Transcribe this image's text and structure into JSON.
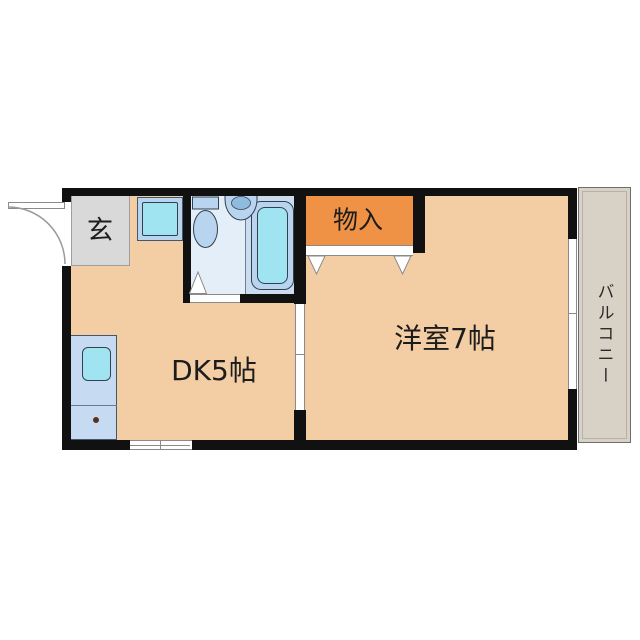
{
  "plan": {
    "type": "apartment-floor-plan",
    "rooms": {
      "entrance": {
        "label": "玄"
      },
      "storage": {
        "label": "物入"
      },
      "dk": {
        "label": "DK5帖"
      },
      "western": {
        "label": "洋室7帖"
      },
      "balcony": {
        "label": "バルコニー"
      }
    },
    "fixtures": [
      "bathtub",
      "toilet",
      "wash-basin",
      "washer-space",
      "kitchen-counter",
      "kitchen-sink",
      "entrance-swing-door",
      "closet-sliding-doors",
      "bathroom-folding-door",
      "balcony-sliding-window",
      "kitchen-window"
    ],
    "colors": {
      "wall": "#111111",
      "floor": "#f3cda4",
      "closet": "#ef9246",
      "entrance_floor": "#d9d9d9",
      "bathroom_floor": "#e4eef8",
      "bath_zone": "#cbdcef",
      "fixture": "#b9d4ee",
      "fixture_inner": "#a0e4f2",
      "balcony_floor": "#d8d1c6"
    }
  }
}
